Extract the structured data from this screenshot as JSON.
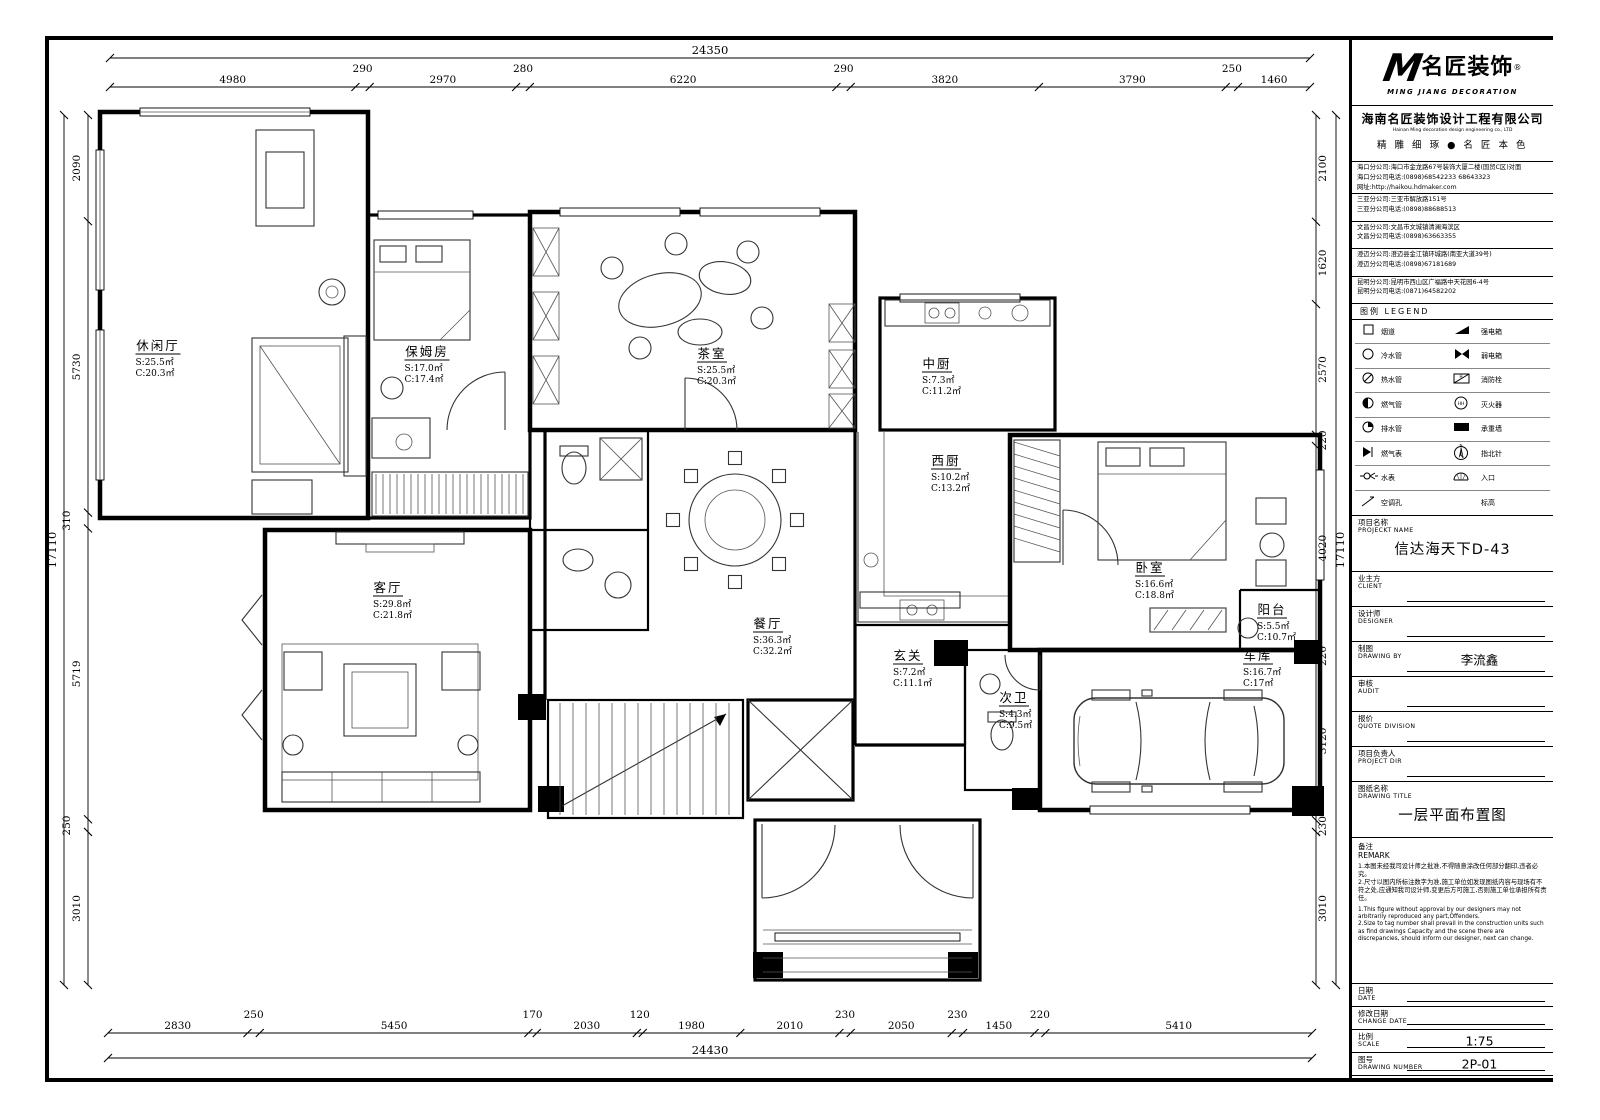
{
  "title_block": {
    "logo": {
      "m": "M",
      "name": "名匠装饰",
      "reg": "®",
      "sub": "MING JIANG DECORATION"
    },
    "company": {
      "cn": "海南名匠装饰设计工程有限公司",
      "en": "Hainan Ming decoration design engineering co., LTD",
      "slogan": "精 雕 细 琢 ● 名 匠 本 色"
    },
    "address_groups": [
      [
        "海口分公司:海口市金龙路67号装饰大厦二楼(国贸C区)对面",
        "海口分公司电话:(0898)68542233 68643323",
        "网址:http://haikou.hdmaker.com"
      ],
      [
        "三亚分公司:三亚市解放路151号",
        "三亚分公司电话:(0898)88688513"
      ],
      [
        "文昌分公司:文昌市文城镇清澜海滨区",
        "文昌分公司电话:(0898)63663355"
      ],
      [
        "澄迈分公司:澄迈县金江镇环城路(南亚大道39号)",
        "澄迈分公司电话:(0898)67181689"
      ],
      [
        "昆明分公司:昆明市西山区广福路中天花园6-4号",
        "昆明分公司电话:(0871)64582202"
      ]
    ],
    "legend": {
      "title_cn": "图例",
      "title_en": "LEGEND",
      "rows": [
        {
          "s1": "flue",
          "l1": "烟道",
          "s2": "power",
          "l2": "强电箱"
        },
        {
          "s1": "cold",
          "l1": "冷水管",
          "s2": "weak",
          "l2": "弱电箱"
        },
        {
          "s1": "hot",
          "l1": "热水管",
          "s2": "hydrant",
          "l2": "消防栓"
        },
        {
          "s1": "gas",
          "l1": "燃气管",
          "s2": "ext",
          "l2": "灭火器"
        },
        {
          "s1": "drain",
          "l1": "排水管",
          "s2": "bearing",
          "l2": "承重墙"
        },
        {
          "s1": "gmeter",
          "l1": "燃气表",
          "s2": "north",
          "l2": "指北针"
        },
        {
          "s1": "wmeter",
          "l1": "水表",
          "s2": "entry",
          "l2": "入口"
        },
        {
          "s1": "achole",
          "l1": "空调孔",
          "s2": "none",
          "l2": "标高"
        }
      ]
    },
    "fields": [
      {
        "cn": "项目名称",
        "en": "PROJECKT NAME",
        "value": "信达海天下D-43",
        "big": true
      },
      {
        "cn": "业主方",
        "en": "CLIENT",
        "value": "",
        "big": false
      },
      {
        "cn": "设计师",
        "en": "DESIGNER",
        "value": "",
        "big": false
      },
      {
        "cn": "制图",
        "en": "DRAWING BY",
        "value": "李流鑫",
        "big": false
      },
      {
        "cn": "审核",
        "en": "AUDIT",
        "value": "",
        "big": false
      },
      {
        "cn": "报价",
        "en": "QUOTE DIVISION",
        "value": "",
        "big": false
      },
      {
        "cn": "项目负责人",
        "en": "PROJECT DIR",
        "value": "",
        "big": false
      },
      {
        "cn": "图纸名称",
        "en": "DRAWING TITLE",
        "value": "一层平面布置图",
        "big": true
      }
    ],
    "remark": {
      "cn_title": "备注",
      "en_title": "REMARK",
      "cn_lines": [
        "1.本图未经我司设计师之批准,不得随意涂改任何部分翻印,违者必究。",
        "2.尺寸以图内所标注数字为准,施工单位如发现图纸内容与现场有不符之处,应通知我司设计师,变更后方可施工,否则施工单位承担所有责任。"
      ],
      "en_lines": [
        "1.This figure without approval by our designers may not arbitrarily reproduced any part,Offenders.",
        "2.Size to tag number shall prevail in the construction units such as find drawings Capacity and the scene there are discrepancies, should inform our designer, next can change."
      ]
    },
    "footer_fields": [
      {
        "cn": "日期",
        "en": "DATE",
        "value": ""
      },
      {
        "cn": "修改日期",
        "en": "CHANGE DATE",
        "value": ""
      },
      {
        "cn": "比例",
        "en": "SCALE",
        "value": "1:75"
      },
      {
        "cn": "图号",
        "en": "DRAWING NUMBER",
        "value": "2P-01"
      }
    ]
  },
  "dimensions": {
    "top": {
      "total": 24350,
      "segments": [
        4980,
        290,
        2970,
        280,
        6220,
        290,
        3820,
        3790,
        250,
        1460
      ]
    },
    "bottom": {
      "total": 24430,
      "segments": [
        2830,
        250,
        5450,
        170,
        2030,
        120,
        1980,
        2010,
        230,
        2050,
        230,
        1450,
        220,
        5410
      ]
    },
    "left": {
      "total": 17110,
      "segments": [
        2090,
        5730,
        310,
        5719,
        250,
        3010
      ]
    },
    "right": {
      "total": 17110,
      "segments": [
        2100,
        1620,
        2570,
        220,
        4020,
        220,
        3120,
        230,
        3010
      ]
    }
  },
  "rooms": [
    {
      "label": "休闲厅",
      "s": "S:25.5㎡",
      "c": "C:20.3㎡",
      "x": 158,
      "y": 350
    },
    {
      "label": "保姆房",
      "s": "S:17.0㎡",
      "c": "C:17.4㎡",
      "x": 427,
      "y": 356
    },
    {
      "label": "茶室",
      "s": "S:25.5㎡",
      "c": "C:20.3㎡",
      "x": 712,
      "y": 358
    },
    {
      "label": "中厨",
      "s": "S:7.3㎡",
      "c": "C:11.2㎡",
      "x": 937,
      "y": 368
    },
    {
      "label": "西厨",
      "s": "S:10.2㎡",
      "c": "C:13.2㎡",
      "x": 946,
      "y": 465
    },
    {
      "label": "卧室",
      "s": "S:16.6㎡",
      "c": "C:18.8㎡",
      "x": 1150,
      "y": 572
    },
    {
      "label": "阳台",
      "s": "S:5.5㎡",
      "c": "C:10.7㎡",
      "x": 1272,
      "y": 614
    },
    {
      "label": "客厅",
      "s": "S:29.8㎡",
      "c": "C:21.8㎡",
      "x": 388,
      "y": 592
    },
    {
      "label": "餐厅",
      "s": "S:36.3㎡",
      "c": "C:32.2㎡",
      "x": 768,
      "y": 628
    },
    {
      "label": "玄关",
      "s": "S:7.2㎡",
      "c": "C:11.1㎡",
      "x": 908,
      "y": 660
    },
    {
      "label": "次卫",
      "s": "S:4.3㎡",
      "c": "C:9.5㎡",
      "x": 1014,
      "y": 702
    },
    {
      "label": "车库",
      "s": "S:16.7㎡",
      "c": "C:17㎡",
      "x": 1258,
      "y": 660
    }
  ]
}
